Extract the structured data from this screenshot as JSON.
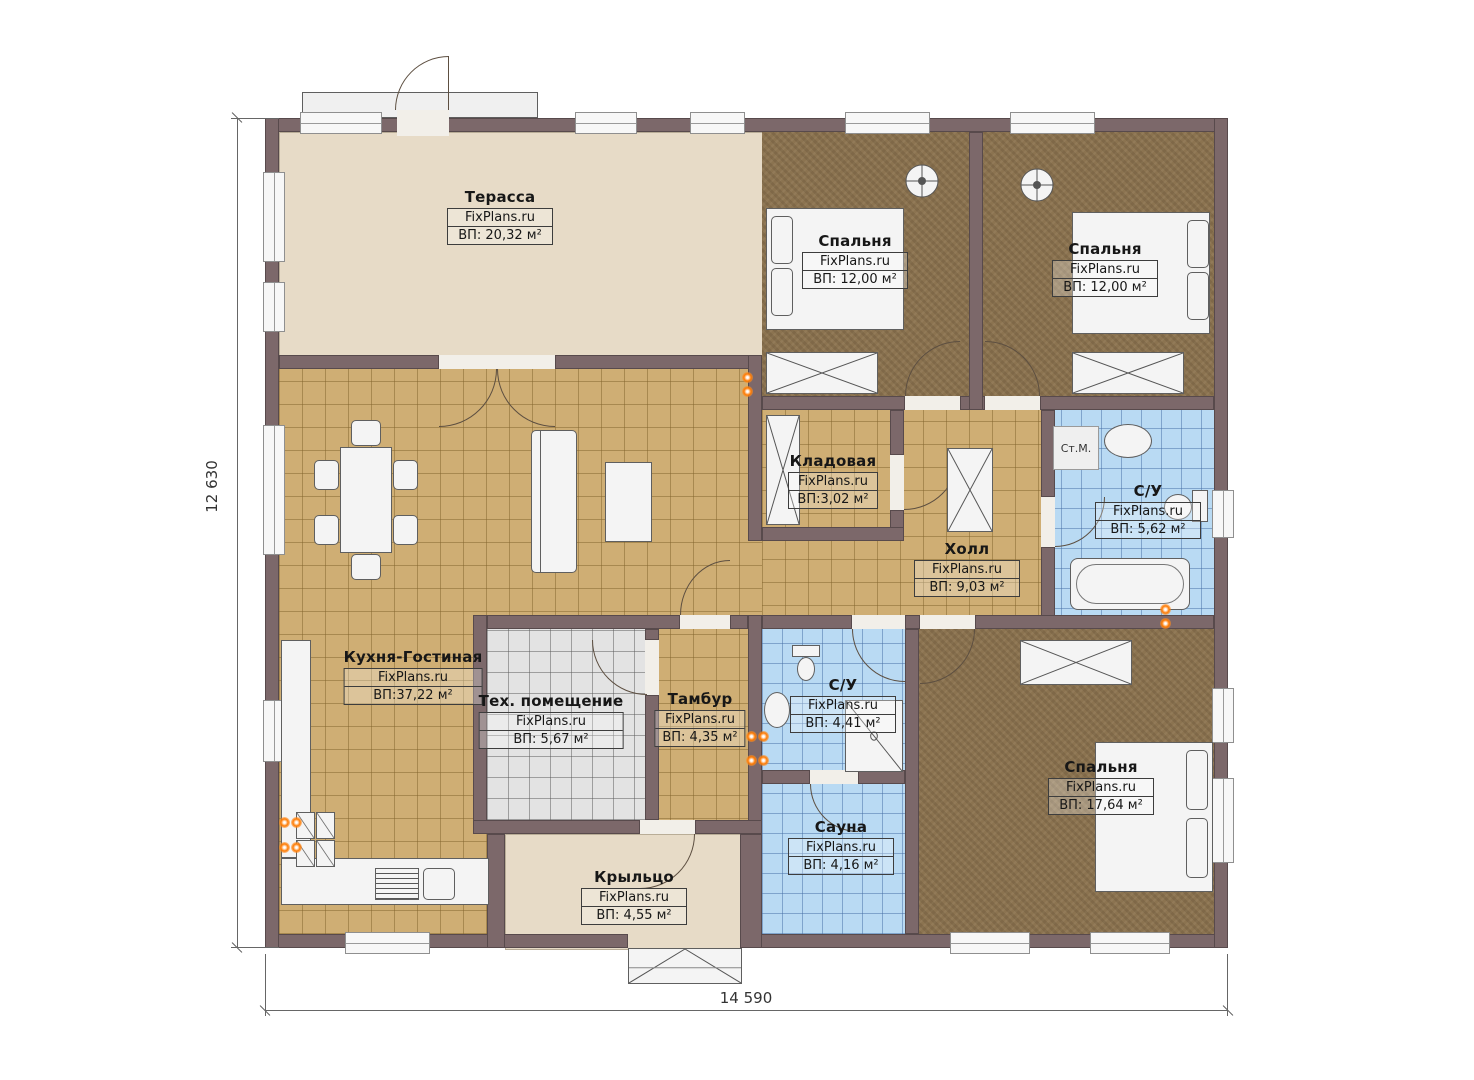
{
  "plan": {
    "brand": "FixPlans.ru",
    "rooms": [
      {
        "id": "terrace",
        "name": "Терасса",
        "area": "ВП: 20,32 м²"
      },
      {
        "id": "bedroom-1",
        "name": "Спальня",
        "area": "ВП: 12,00 м²"
      },
      {
        "id": "bedroom-2",
        "name": "Спальня",
        "area": "ВП: 12,00 м²"
      },
      {
        "id": "storage",
        "name": "Кладовая",
        "area": "ВП:3,02 м²"
      },
      {
        "id": "hall",
        "name": "Холл",
        "area": "ВП: 9,03 м²"
      },
      {
        "id": "bathroom-1",
        "name": "С/У",
        "area": "ВП: 5,62 м²"
      },
      {
        "id": "kitchen-living",
        "name": "Кухня-Гостиная",
        "area": "ВП:37,22 м²"
      },
      {
        "id": "tech-room",
        "name": "Тех. помещение",
        "area": "ВП: 5,67 м²"
      },
      {
        "id": "vestibule",
        "name": "Тамбур",
        "area": "ВП: 4,35 м²"
      },
      {
        "id": "bathroom-2",
        "name": "С/У",
        "area": "ВП: 4,41 м²"
      },
      {
        "id": "sauna",
        "name": "Сауна",
        "area": "ВП: 4,16 м²"
      },
      {
        "id": "bedroom-3",
        "name": "Спальня",
        "area": "ВП: 17,64 м²"
      },
      {
        "id": "porch",
        "name": "Крыльцо",
        "area": "ВП: 4,55 м²"
      }
    ],
    "annotations": {
      "washing_machine": "Ст.М."
    },
    "dimensions": {
      "horizontal": "14 590",
      "vertical": "12 630"
    },
    "colors": {
      "wall": "#7c686a",
      "terrace_floor": "#e7dbc7",
      "tile_tan": "#cfae74",
      "tile_blue": "#b9daf3",
      "tile_gray": "#e3e3e3",
      "carpet": "#8b7350",
      "radiator": "#ff7a00"
    }
  }
}
